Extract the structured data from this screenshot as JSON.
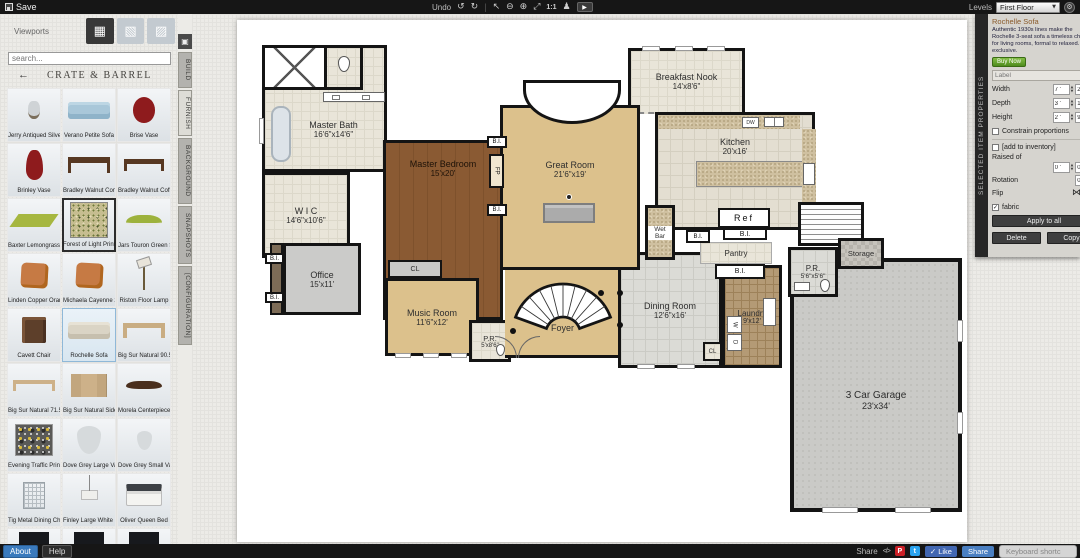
{
  "topbar": {
    "save": "Save",
    "undo_label": "Undo",
    "icons": {
      "undo": "↺",
      "redo": "↻",
      "select": "↖",
      "zoom_out": "⊖",
      "zoom_in": "⊕",
      "fit": "⤢",
      "one2one": "1:1",
      "walk": "♟",
      "video": "▶",
      "gear": "⚙",
      "caret": "▼"
    },
    "levels_label": "Levels",
    "level_value": "First Floor"
  },
  "sidebar": {
    "viewports_label": "Viewports",
    "viewport_icons": {
      "plan2d": "▦",
      "view3d_a": "▧",
      "view3d_b": "▨"
    },
    "search_placeholder": "search...",
    "back_arrow": "←",
    "catalog_title": "CRATE & BARREL",
    "collapse_glyph": "▣",
    "tabs": [
      {
        "label": "BUILD",
        "active": false
      },
      {
        "label": "FURNISH",
        "active": true
      },
      {
        "label": "BACKGROUND",
        "active": false
      },
      {
        "label": "SNAPSHOTS",
        "active": false
      },
      {
        "label": "[CONFIGURATION]",
        "active": false
      }
    ],
    "items": [
      {
        "label": "Jerry Antiqued Silve...",
        "thumb": "pitcher-silver"
      },
      {
        "label": "Verano Petite Sofa",
        "thumb": "sofa-blue"
      },
      {
        "label": "Brise Vase",
        "thumb": "vase-red-round"
      },
      {
        "label": "Brinley Vase",
        "thumb": "vase-red-tall"
      },
      {
        "label": "Bradley Walnut Con...",
        "thumb": "console-walnut"
      },
      {
        "label": "Bradley Walnut Coff...",
        "thumb": "coffee-walnut"
      },
      {
        "label": "Baxter Lemongrass ...",
        "thumb": "rug-green"
      },
      {
        "label": "Forest of Light Print",
        "thumb": "print-forest",
        "selected": "dark"
      },
      {
        "label": "Jars Touron Green S...",
        "thumb": "bowl-green"
      },
      {
        "label": "Linden Copper Oran...",
        "thumb": "pillow-orange"
      },
      {
        "label": "Michaela Cayenne 2...",
        "thumb": "pillow-orange"
      },
      {
        "label": "Riston Floor Lamp",
        "thumb": "lamp-floor"
      },
      {
        "label": "Cavett Chair",
        "thumb": "chair-brown"
      },
      {
        "label": "Rochelle Sofa",
        "thumb": "sofa-beige",
        "selected": "blue"
      },
      {
        "label": "Big Sur Natural 90.5...",
        "thumb": "table-wood"
      },
      {
        "label": "Big Sur Natural 71.5...",
        "thumb": "bench-wood"
      },
      {
        "label": "Big Sur Natural Side...",
        "thumb": "sideboard-wood"
      },
      {
        "label": "Morela Centerpiece ...",
        "thumb": "bowl-dark"
      },
      {
        "label": "Evening Traffic Print",
        "thumb": "print-dark"
      },
      {
        "label": "Dove Grey Large Vase",
        "thumb": "vase-grey-large"
      },
      {
        "label": "Dove Grey Small Vase",
        "thumb": "vase-grey-small"
      },
      {
        "label": "Tig Metal Dining Ch...",
        "thumb": "chair-wire"
      },
      {
        "label": "Finley Large White P...",
        "thumb": "pendant-white"
      },
      {
        "label": "Oliver Queen Bed",
        "thumb": "bed-queen"
      },
      {
        "label": "",
        "thumb": "box-dark"
      },
      {
        "label": "",
        "thumb": "box-dark"
      },
      {
        "label": "",
        "thumb": "box-dark"
      }
    ]
  },
  "plan": {
    "rooms": {
      "master_bath": {
        "name": "Master Bath",
        "dims": "16'6\"x14'6\""
      },
      "wic": {
        "name": "W I C",
        "dims": "14'6\"x10'6\""
      },
      "master_bedroom": {
        "name": "Master Bedroom",
        "dims": "15'x20'"
      },
      "office": {
        "name": "Office",
        "dims": "15'x11'"
      },
      "music_room": {
        "name": "Music Room",
        "dims": "11'6\"x12'"
      },
      "pr1": {
        "name": "P.R.",
        "dims": "5'x8'6\""
      },
      "great_room": {
        "name": "Great Room",
        "dims": "21'6\"x19'"
      },
      "foyer": {
        "name": "Foyer"
      },
      "breakfast_nook": {
        "name": "Breakfast Nook",
        "dims": "14'x8'6\""
      },
      "kitchen": {
        "name": "Kitchen",
        "dims": "20'x16'"
      },
      "wet_bar": {
        "name": "Wet Bar"
      },
      "pantry": {
        "name": "Pantry"
      },
      "dining_room": {
        "name": "Dining Room",
        "dims": "12'6\"x16'"
      },
      "laundry": {
        "name": "Laundry",
        "dims": "9'x12'"
      },
      "pr2": {
        "name": "P.R.",
        "dims": "5'6\"x5'6\""
      },
      "storage": {
        "name": "Storage"
      },
      "garage": {
        "name": "3 Car Garage",
        "dims": "23'x34'"
      }
    },
    "tags": {
      "bi": "B.I.",
      "fp": "FP",
      "cl": "CL",
      "ref": "Ref",
      "dw": "DW",
      "w": "W",
      "d": "D"
    }
  },
  "properties": {
    "panel_title": "SELECTED ITEM PROPERTIES",
    "item_title": "Rochelle Sofa",
    "description": "Authentic 1930s lines make the Rochelle 3-seat sofa a timeless choice for living rooms, formal to relaxed. An exclusive.",
    "buy_now": "Buy Now",
    "label_placeholder": "Label",
    "width_label": "Width",
    "width_ft": "7 '",
    "width_in": "2 \"",
    "depth_label": "Depth",
    "depth_ft": "3 '",
    "depth_in": "1 \"",
    "height_label": "Height",
    "height_ft": "2 '",
    "height_in": "9.5 \"",
    "constrain_label": "Constrain proportions",
    "inventory_label": "[add to inventory]",
    "raised_label": "Raised of",
    "raised_ft": "0 '",
    "raised_in": "0 \"",
    "rotation_label": "Rotation",
    "rotation_value": "0",
    "flip_label": "Flip",
    "fabric_label": "fabric",
    "fabric_checked": "✓",
    "apply_all": "Apply to all",
    "delete_label": "Delete",
    "copy_label": "Copy",
    "accent_green": "#4e8c1e"
  },
  "bottombar": {
    "about": "About",
    "help": "Help",
    "share_label": "Share",
    "embed_glyph": "</>",
    "pinterest_glyph": "P",
    "twitter_glyph": "t",
    "like_label": "✓ Like",
    "share_btn": "Share",
    "keyboard_label": "Keyboard shortc",
    "accent_blue": "#3a7abd"
  }
}
